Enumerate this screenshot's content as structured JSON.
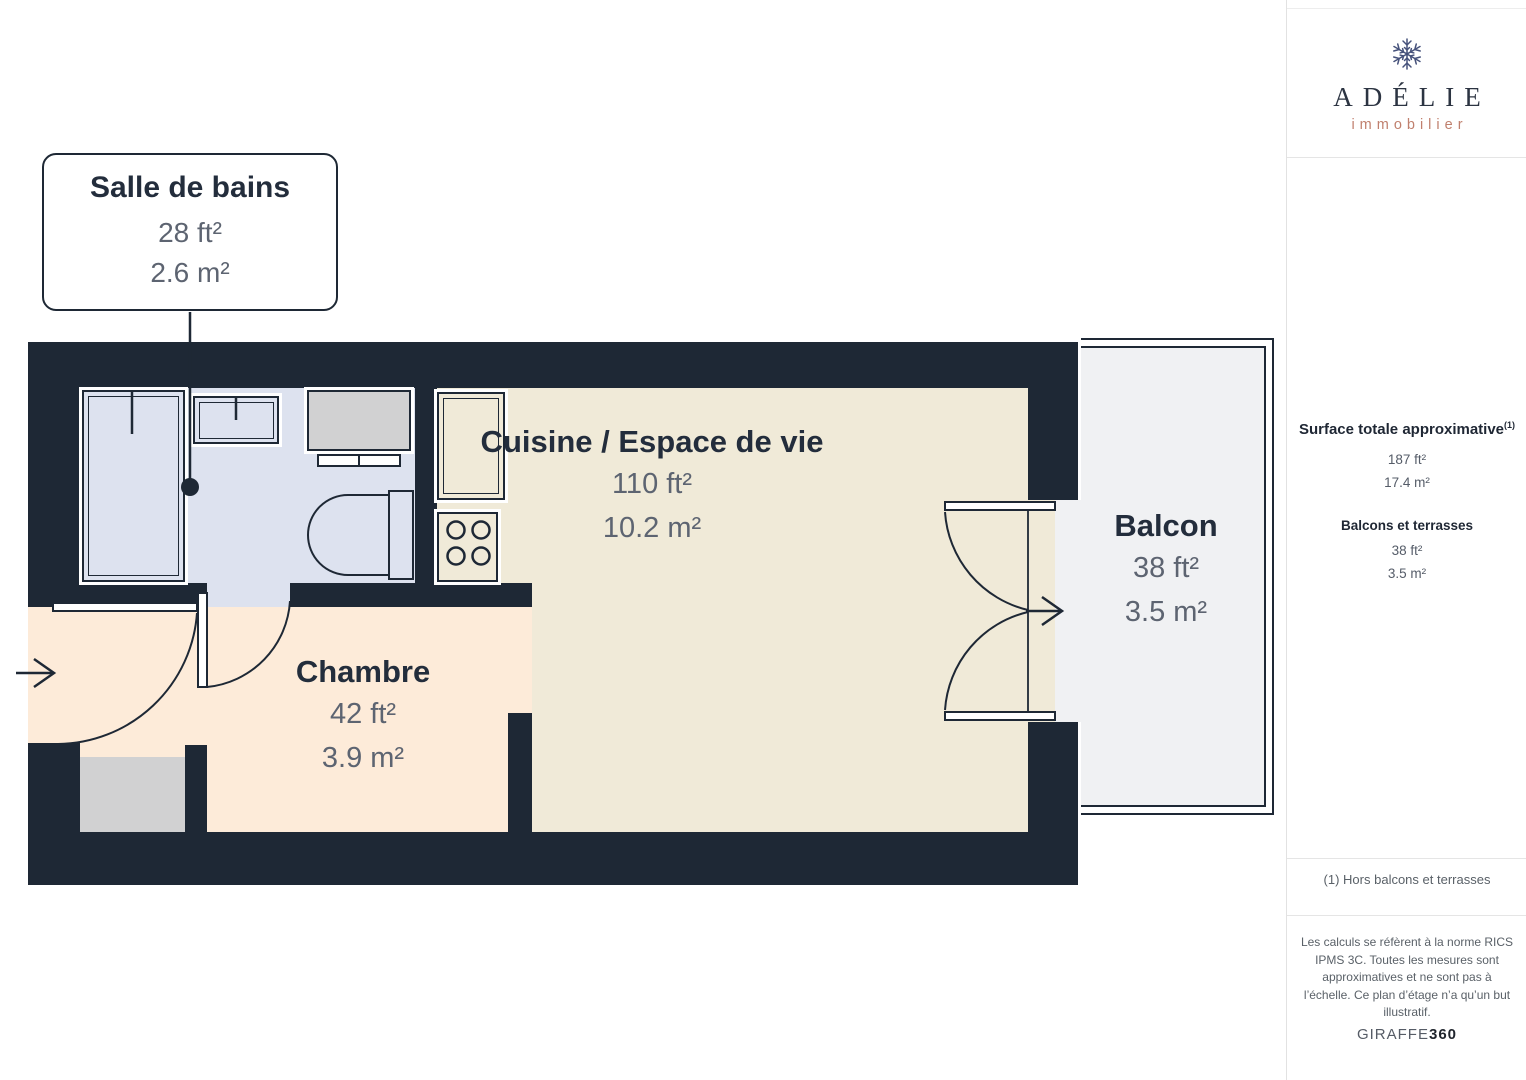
{
  "plan": {
    "callout": {
      "title": "Salle de bains",
      "ft": "28 ft²",
      "m": "2.6 m²"
    },
    "rooms": [
      {
        "name": "Cuisine / Espace de vie",
        "ft": "110 ft²",
        "m": "10.2 m²"
      },
      {
        "name": "Chambre",
        "ft": "42 ft²",
        "m": "3.9 m²"
      },
      {
        "name": "Balcon",
        "ft": "38 ft²",
        "m": "3.5 m²"
      }
    ]
  },
  "sidebar": {
    "brand": {
      "name": "ADÉLIE",
      "tagline": "immobilier",
      "logo_icon": "snowflake-icon"
    },
    "surface": {
      "title": "Surface totale approximative",
      "sup": "(1)",
      "ft": "187 ft²",
      "m": "17.4 m²"
    },
    "balconies": {
      "title": "Balcons et terrasses",
      "ft": "38 ft²",
      "m": "3.5 m²"
    },
    "footnote": "(1) Hors balcons et terrasses",
    "legal_lines": [
      "Les calculs se réfèrent à la norme RICS",
      "IPMS 3C. Toutes les mesures sont",
      "approximatives et ne sont pas à",
      "l’échelle. Ce plan d’étage n’a qu’un but",
      "illustratif."
    ],
    "watermark": {
      "giraffe": "GIRAFFE",
      "n360": "360"
    }
  },
  "colors": {
    "wall": "#1e2835",
    "bathroom_floor": "#dde2ef",
    "living_floor": "#f0ead8",
    "bedroom_floor": "#fdebd9",
    "balcony_floor": "#f0f1f3",
    "fixture_gray": "#d1d1d2",
    "brand_accent": "#c0806e",
    "label_text": "#232d3c",
    "value_text": "#5d6471"
  }
}
